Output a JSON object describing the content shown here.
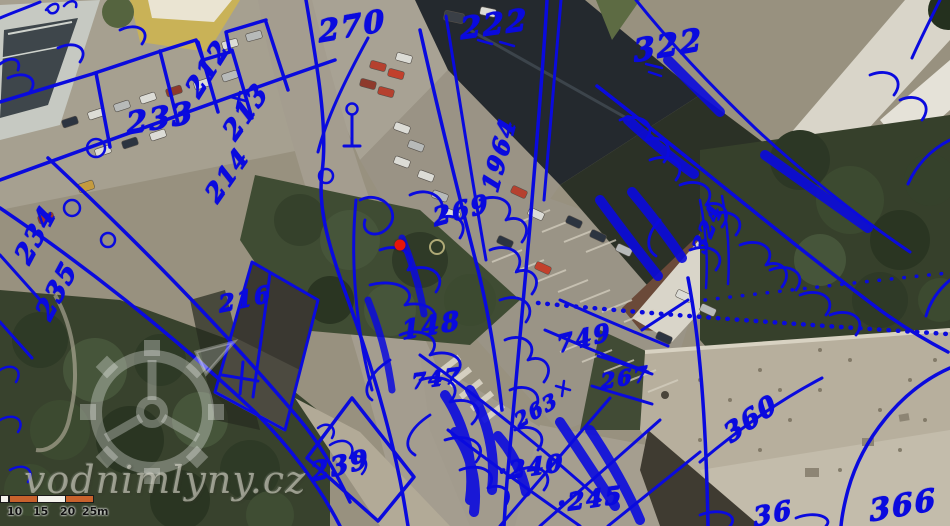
{
  "map": {
    "type": "aerial-orthophoto-with-cadastral-overlay",
    "overlay_color": "#0a0ade",
    "marker": {
      "name": "mill-location-marker",
      "color": "#e8150a",
      "x": 400,
      "y": 245
    },
    "highlight_ring": {
      "color": "#c5bd85",
      "x": 437,
      "y": 247
    },
    "parcel_labels": [
      {
        "text": "270",
        "x": 352,
        "y": 27,
        "rot": -10,
        "size": 30
      },
      {
        "text": "222",
        "x": 494,
        "y": 25,
        "rot": -8,
        "size": 30
      },
      {
        "text": "322",
        "x": 668,
        "y": 46,
        "rot": -10,
        "size": 31
      },
      {
        "text": "212",
        "x": 208,
        "y": 69,
        "rot": -58,
        "size": 26
      },
      {
        "text": "213",
        "x": 246,
        "y": 112,
        "rot": -55,
        "size": 26
      },
      {
        "text": "233",
        "x": 160,
        "y": 119,
        "rot": -10,
        "size": 30
      },
      {
        "text": "214",
        "x": 227,
        "y": 175,
        "rot": -55,
        "size": 25
      },
      {
        "text": "234",
        "x": 36,
        "y": 235,
        "rot": -62,
        "size": 26
      },
      {
        "text": "235",
        "x": 57,
        "y": 291,
        "rot": -62,
        "size": 26
      },
      {
        "text": "216",
        "x": 245,
        "y": 299,
        "rot": -12,
        "size": 23
      },
      {
        "text": "1964",
        "x": 499,
        "y": 155,
        "rot": -75,
        "size": 24
      },
      {
        "text": "269",
        "x": 461,
        "y": 210,
        "rot": -15,
        "size": 25
      },
      {
        "text": "148",
        "x": 431,
        "y": 326,
        "rot": -10,
        "size": 26
      },
      {
        "text": "747",
        "x": 436,
        "y": 378,
        "rot": -8,
        "size": 21
      },
      {
        "text": "749",
        "x": 584,
        "y": 338,
        "rot": -14,
        "size": 24
      },
      {
        "text": "267",
        "x": 625,
        "y": 377,
        "rot": -10,
        "size": 21
      },
      {
        "text": "239",
        "x": 340,
        "y": 466,
        "rot": -14,
        "size": 26
      },
      {
        "text": "·240",
        "x": 531,
        "y": 467,
        "rot": -8,
        "size": 24
      },
      {
        "text": "·245",
        "x": 590,
        "y": 499,
        "rot": -8,
        "size": 24
      },
      {
        "text": "263",
        "x": 536,
        "y": 410,
        "rot": -30,
        "size": 20
      },
      {
        "text": "360",
        "x": 751,
        "y": 419,
        "rot": -35,
        "size": 26
      },
      {
        "text": "366",
        "x": 903,
        "y": 506,
        "rot": -10,
        "size": 30
      },
      {
        "text": "324",
        "x": 707,
        "y": 228,
        "rot": -68,
        "size": 21
      },
      {
        "text": "36",
        "x": 773,
        "y": 514,
        "rot": -12,
        "size": 26
      }
    ],
    "symbols": [
      "streetlight-symbol",
      "well-circle-symbol",
      "tree-circle-symbol",
      "survey-cross-symbol",
      "church-cross-symbol",
      "dotted-boundary-line"
    ]
  },
  "watermark": {
    "site_text": "vodnimlyny.cz",
    "logo": "watermill-gear-logo"
  },
  "scale_bar": {
    "tick_labels": [
      "10",
      "15",
      "20",
      "25"
    ],
    "tick_positions": [
      7,
      33,
      60,
      82
    ],
    "unit_label": "m",
    "segment_color": "#c8622d",
    "segments": [
      {
        "x": 0,
        "w": 9,
        "orange": false
      },
      {
        "x": 9,
        "w": 29,
        "orange": true
      },
      {
        "x": 37,
        "w": 29,
        "orange": false
      },
      {
        "x": 65,
        "w": 29,
        "orange": true
      }
    ]
  }
}
